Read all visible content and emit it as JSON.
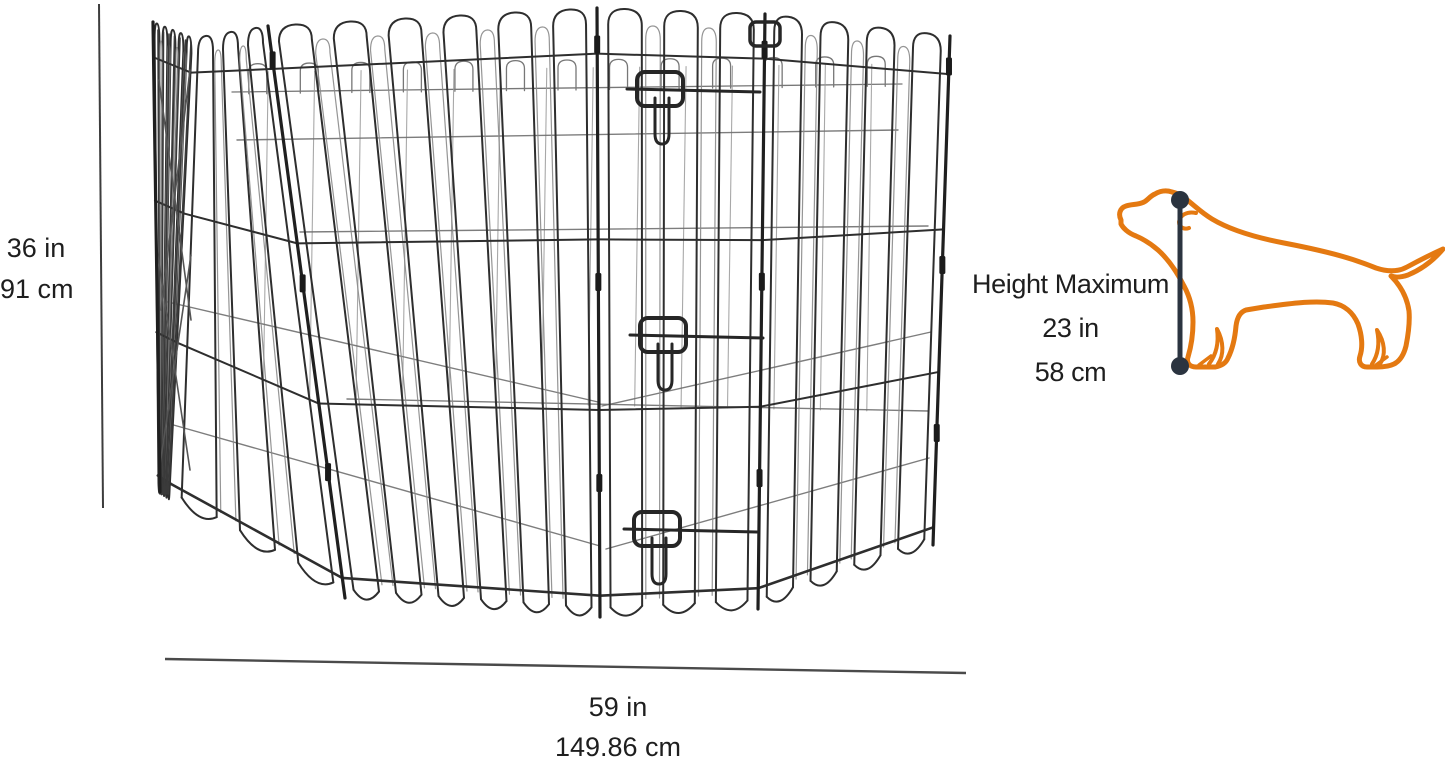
{
  "labels": {
    "pen_height": {
      "inches": "36 in",
      "centimeters": "91 cm"
    },
    "pen_width": {
      "inches": "59 in",
      "centimeters": "149.86 cm"
    },
    "dog_height": {
      "title": "Height Maximum",
      "inches": "23 in",
      "centimeters": "58 cm"
    }
  },
  "icons": {
    "pen_illustration": "octagonal-wire-exercise-pen-with-door-and-latches",
    "dog_illustration": "dog-outline-side-profile",
    "measure_line": "vertical-measurement-line-with-end-dots"
  },
  "colors": {
    "background": "#ffffff",
    "text": "#1e1e1e",
    "wire": "#2e2e2e",
    "dimension_line": "#3d3d3d",
    "dog_outline_orange": "#e47911",
    "measure_line_dark": "#2b3440"
  }
}
